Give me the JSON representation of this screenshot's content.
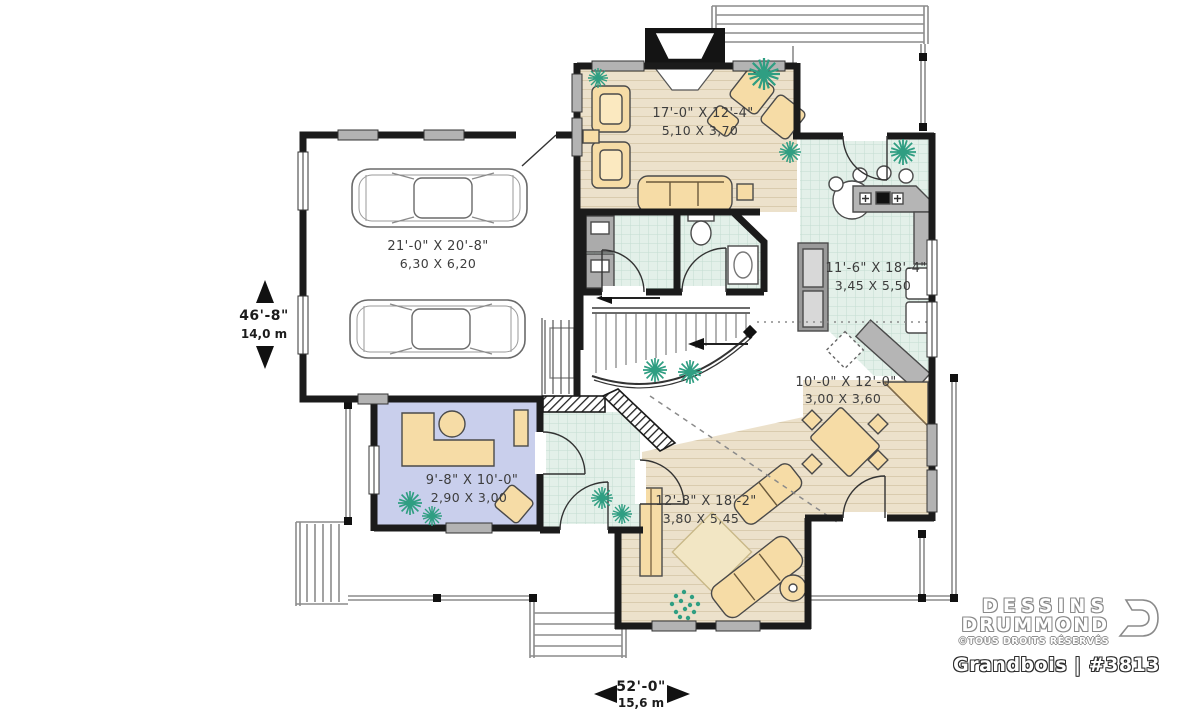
{
  "plan": {
    "rooms": {
      "garage": {
        "imperial": "21'-0\" X 20'-8\"",
        "metric": "6,30 X 6,20"
      },
      "living": {
        "imperial": "17'-0\" X 12'-4\"",
        "metric": "5,10 X 3,70"
      },
      "kitchen": {
        "imperial": "11'-6\" X 18'-4\"",
        "metric": "3,45 X 5,50"
      },
      "dining": {
        "imperial": "10'-0\" X 12'-0\"",
        "metric": "3,00 X 3,60"
      },
      "family": {
        "imperial": "12'-8\" X 18'-2\"",
        "metric": "3,80 X 5,45"
      },
      "office": {
        "imperial": "9'-8\" X 10'-0\"",
        "metric": "2,90 X 3,00"
      }
    },
    "dimensions": {
      "side": {
        "imperial": "46'-8\"",
        "metric": "14,0 m"
      },
      "front": {
        "imperial": "52'-0\"",
        "metric": "15,6 m"
      }
    }
  },
  "branding": {
    "name_line1": "DESSINS",
    "name_line2": "DRUMMOND",
    "rights": "©TOUS DROITS RÉSERVÉS",
    "plan_label": "Grandbois | #3813"
  },
  "colors": {
    "wood-floor": "#ece1cb",
    "tile-floor": "#e3f0e9",
    "office-floor": "#c9cfec",
    "furniture": "#f6dca6",
    "plant": "#2f9e82",
    "wall": "#1b1b1b",
    "counter": "#b5b5b5",
    "rug": "#f2e6c4"
  }
}
